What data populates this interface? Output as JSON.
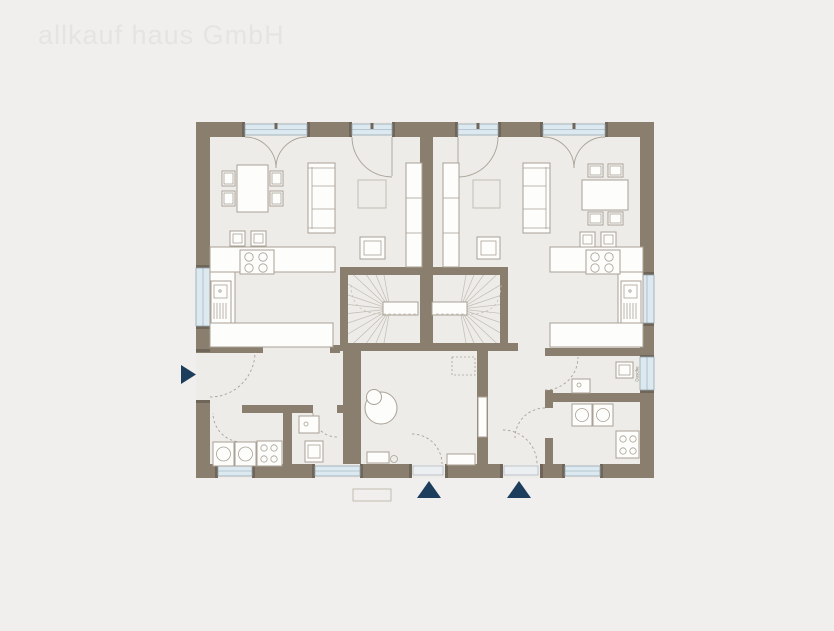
{
  "watermark": {
    "text": "allkauf haus GmbH"
  },
  "plan": {
    "labels": {
      "shower_left": "Dusche",
      "shower_right": "Dusche",
      "shower_right_wall": "Dusche"
    }
  },
  "colors": {
    "background": "#f0efed",
    "floor": "#edece9",
    "wall": "#8a7e6f",
    "cap": "#6f6659",
    "furniture-fill": "#fdfdfc",
    "furniture-stroke": "#a9a195",
    "window-fill": "#dde9f1",
    "window-stroke": "#94a4b0",
    "line": "#aaa296",
    "stair": "#c2bcb2",
    "arrow": "#1c3d5c",
    "watermark": "#e5e4e1",
    "label": "#8a8072"
  }
}
